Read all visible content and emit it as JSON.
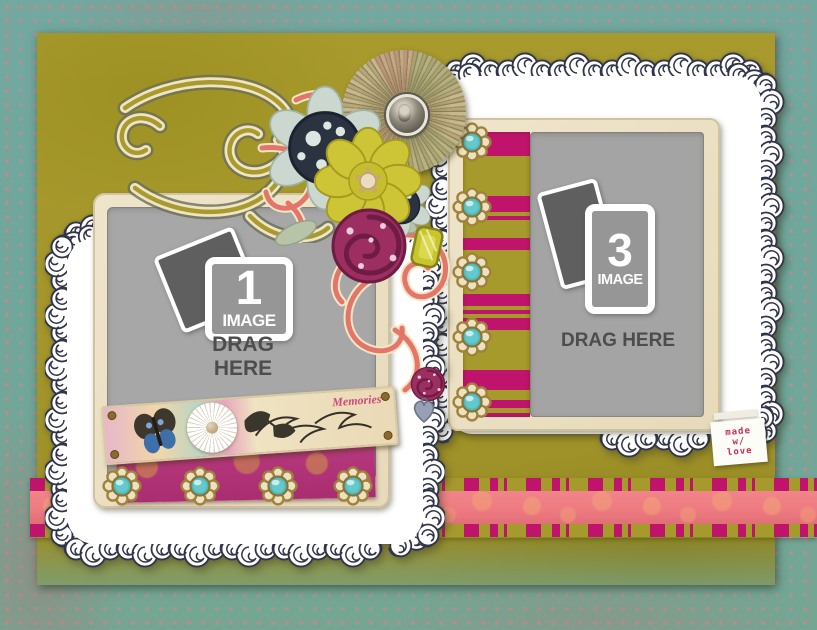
{
  "dropzones": {
    "left": {
      "number": "1",
      "unit": "IMAGE",
      "instruction": "DRAG HERE"
    },
    "right": {
      "number": "3",
      "unit": "IMAGE",
      "instruction": "DRAG HERE"
    }
  },
  "banner": {
    "caption": "Memories"
  },
  "tag": {
    "lines": [
      "made",
      "w/",
      "love"
    ]
  },
  "palette": {
    "teal_border": "#6fa79c",
    "olive_page": "#a3952a",
    "magenta_stripe": "#c0146c",
    "ribbon_pink": "#ee7b80",
    "cream_frame": "#eadfc4",
    "placeholder_gray": "#a7a7a7",
    "lace_ink": "#30344a",
    "coral_flourish": "#e4756b",
    "chartreuse_flower": "#cdc535",
    "turquoise_brad": "#4fb9c0",
    "brass": "#a0823d",
    "tag_text": "#cc2a58"
  },
  "icons": [
    "photo-stack-icon",
    "flower-brad-icon",
    "butterfly-icon",
    "fan-rosette-icon",
    "rose-icon",
    "heart-charm-icon",
    "gem-icon",
    "lace-doily",
    "flourish-swirl"
  ]
}
